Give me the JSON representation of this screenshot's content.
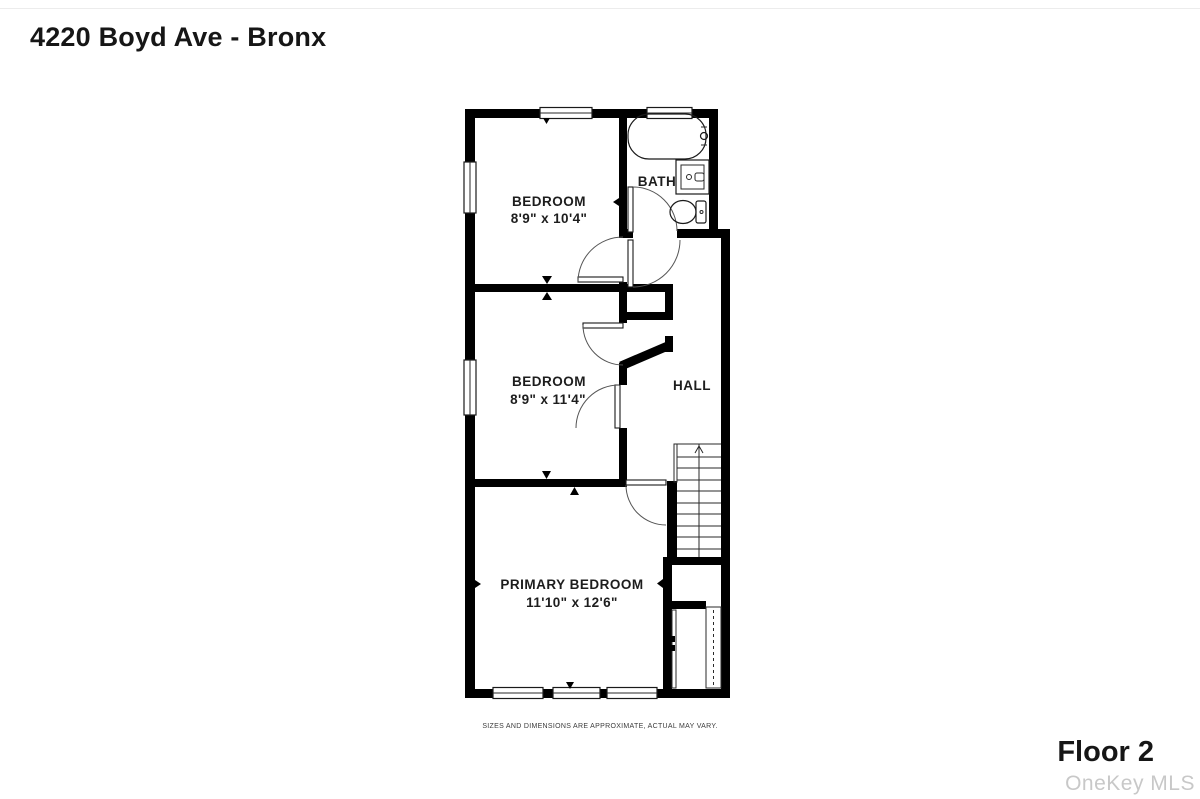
{
  "header": {
    "title": "4220 Boyd Ave - Bronx"
  },
  "footer": {
    "floor_label": "Floor 2",
    "watermark": "OneKey MLS",
    "disclaimer": "SIZES AND DIMENSIONS ARE APPROXIMATE, ACTUAL MAY VARY."
  },
  "floor_plan": {
    "bedroom1": {
      "name": "BEDROOM",
      "dims": "8'9\" x 10'4\""
    },
    "bedroom2": {
      "name": "BEDROOM",
      "dims": "8'9\" x 11'4\""
    },
    "primary": {
      "name": "PRIMARY BEDROOM",
      "dims": "11'10\" x 12'6\""
    },
    "bath_label": "BATH",
    "hall_label": "HALL",
    "fixtures": [
      "bathtub",
      "sink-vanity",
      "toilet",
      "staircase-up"
    ]
  },
  "colors": {
    "wall-color": "#000000",
    "text-primary": "#161616",
    "watermark-color": "#c8c8c8"
  }
}
